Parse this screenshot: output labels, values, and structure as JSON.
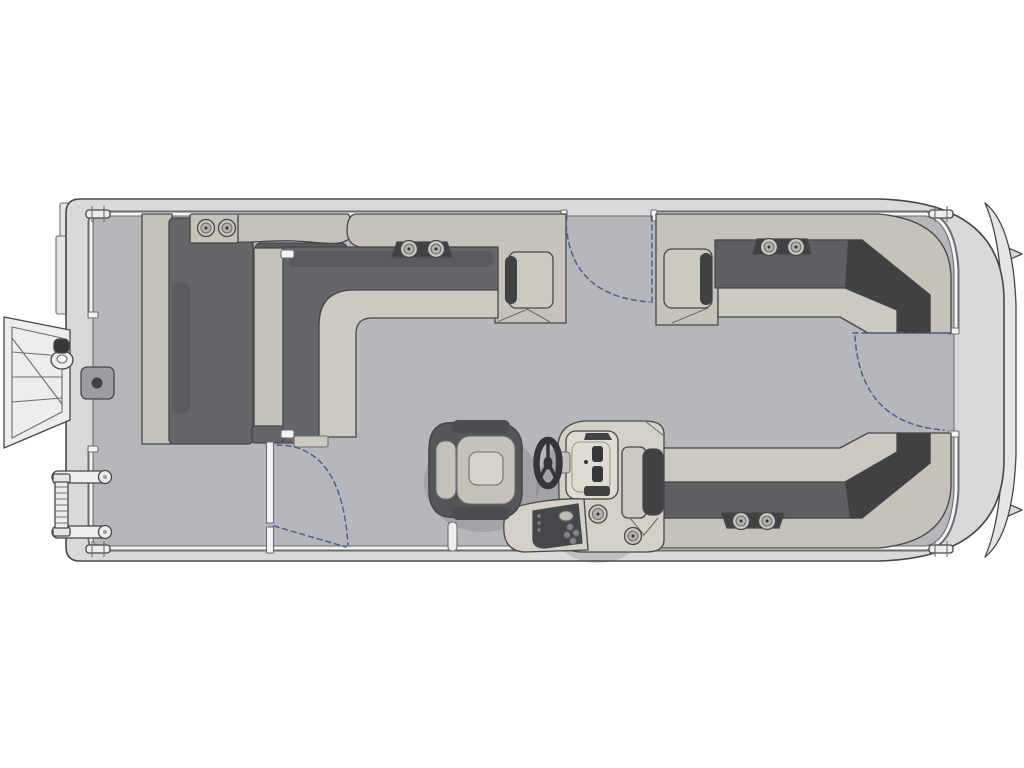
{
  "page": {
    "background": "#ffffff",
    "description": "Top-view pontoon boat floor plan line diagram, bow to the right, stern swim deck to the left"
  },
  "colors": {
    "page_bg": "#ffffff",
    "line": "#45474a",
    "line_soft": "#6b6d70",
    "hull_band": "#d8d9da",
    "hull_trim": "#e4e5e6",
    "rail_white": "#f3f4f5",
    "floor": "#b5b7ba",
    "base_light": "#c6c2ba",
    "seat_light": "#cdc9c1",
    "cushion_dark": "#64666a",
    "cushion_mid": "#595b5f",
    "pocket_dark": "#3f4143",
    "slat_dark": "#34363a",
    "console": "#d4d0c8",
    "dash_recess": "#dfdbd3",
    "chair_shell": "#54565a",
    "chair_trim": "#4b4d50",
    "cushion_pale": "#c6c2ba",
    "insert_pale": "#d6d2ca",
    "metal": "#eceded",
    "gate_dash": "#4e5d94",
    "shadow": "rgba(60,62,66,0.16)"
  },
  "components": {
    "hull": [
      "gunwale",
      "deck-floor",
      "side-rail",
      "bow-nose-cone",
      "nose-fins",
      "stern-trim"
    ],
    "mooring_cleats": 4,
    "stern_boarding": {
      "swim_gate": "open (shown swung outboard)",
      "boarding_ladder": "stowed",
      "grab_handle": 1,
      "latch_plate": 1
    },
    "gates_with_swing_arcs": [
      "port-side-gate",
      "bow-gate",
      "cockpit-partition-gate"
    ],
    "seating": {
      "stern_chaise_lounge": {
        "cupholders": 2
      },
      "port_l_shaped_bench": {
        "cupholders": 2,
        "armrest_with_pocket": true
      },
      "starboard_bow_lounge": {
        "cupholders": 2,
        "armrest_with_pocket": true
      },
      "starboard_aft_bench": {
        "cupholders": 2,
        "armrest_with_pocket": true
      },
      "captains_chair": 1
    },
    "helm": {
      "steering_wheel": 1,
      "dash_panel_gauges": 2,
      "switch_panel_buttons": 4,
      "cupholder": 1
    },
    "deck_fittings": {
      "deck_cupholder": 1,
      "tow_pylon_post": 1
    }
  }
}
